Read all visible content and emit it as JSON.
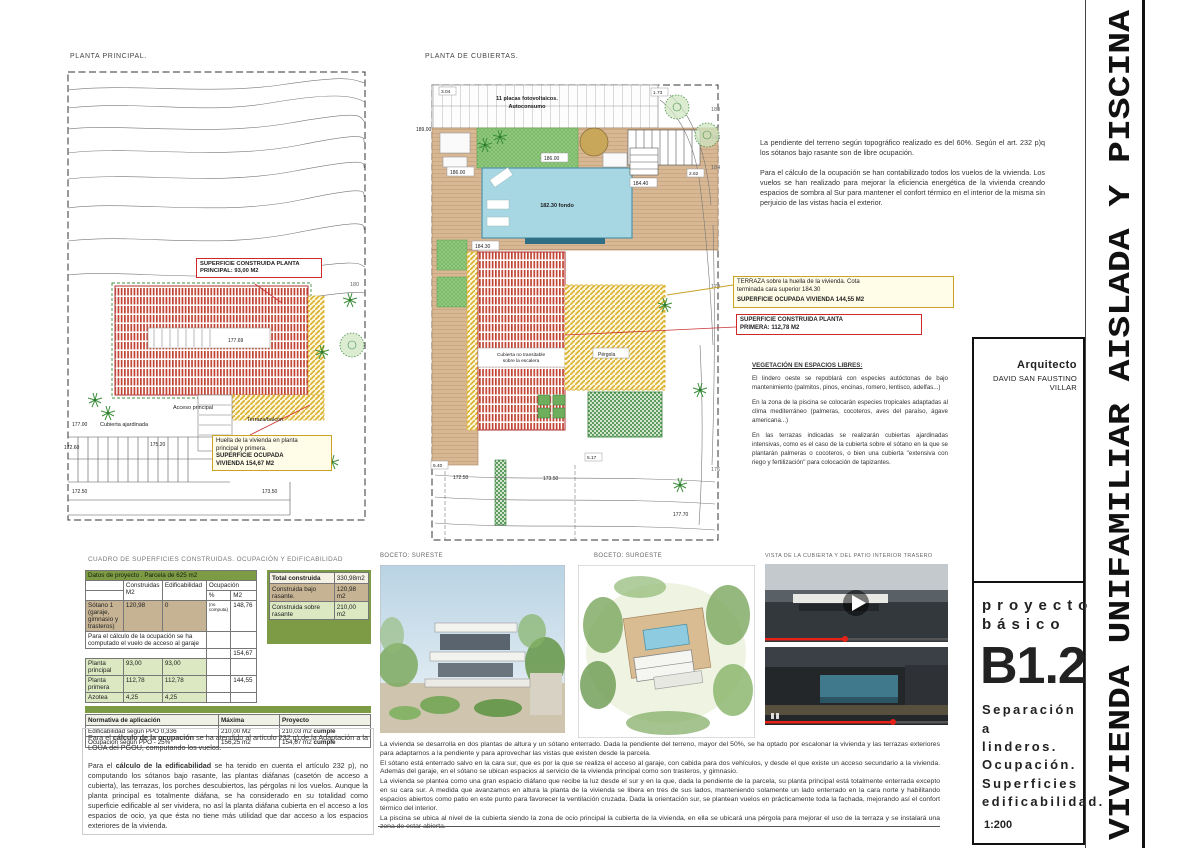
{
  "sheet": {
    "vertical_title": "VIVIENDA UNIFAMILIAR AISLADA Y PISCINA",
    "scale": "1:200",
    "architect_label": "Arquitecto",
    "architect_name": "DAVID SAN FAUSTINO VILLAR",
    "project_line1": "proyecto",
    "project_line2": "básico",
    "sheet_code": "B1.2",
    "subtitle_lines": {
      "l1": "Separación a",
      "l2": "linderos.",
      "l3": "Ocupación.",
      "l4": "Superficies",
      "l5": "edificabilidad."
    }
  },
  "colors": {
    "table_green": "#7d9a45",
    "table_green_light": "#dce8c2",
    "table_tan": "#c6b393",
    "pool_blue": "#a6d7e3",
    "deck_tan": "#d8b894",
    "grass_green": "#92c97f",
    "hatch_red": "#c14333",
    "hatch_yellow": "#d9af2b",
    "label_red_border": "#cc2a2a",
    "label_yellow_bg": "#fffce8",
    "progress_red": "#e62117"
  },
  "plan1": {
    "title": "PLANTA PRINCIPAL.",
    "box_construida": {
      "line1": "SUPERFICIE CONSTRUIDA PLANTA",
      "line2": "PRINCIPAL:  93,00 M2"
    },
    "box_huella": {
      "line1": "Huella de la vivienda en planta",
      "line2": "principal y primera.",
      "line3": "SUPERFICIE OCUPADA",
      "line4": "VIVIENDA 154,67 M2"
    },
    "labels": {
      "acceso": "Acceso principal",
      "terraza": "Terraza/balcón",
      "cubierta": "Cubierta ajardinada"
    },
    "levels": {
      "v17700": "177.00",
      "v17260": "172.60",
      "v17520": "175.20",
      "v17250": "172.50",
      "v17350": "173.50",
      "v17769": "177.69",
      "c180": "180"
    }
  },
  "plan2": {
    "title": "PLANTA DE CUBIERTAS.",
    "placas_line1": "11 placas fotovoltaicos.",
    "placas_line2": "Autoconsumo",
    "labels": {
      "pool": "182.30 fondo",
      "cubierta_escalera_1": "Cubierta no transitable",
      "cubierta_escalera_2": "sobre la escalera",
      "pergola": "Pérgola"
    },
    "box_terraza": {
      "line1": "TERRAZA sobre la huella de la vivienda.  Cota",
      "line2": "terminada cara superior 184.30",
      "line3": "SUPERFICIE OCUPADA VIVIENDA 144,55 M2"
    },
    "box_primera": {
      "line1": "SUPERFICIE CONSTRUIDA PLANTA",
      "line2": "PRIMERA:  112,78 M2"
    },
    "levels": {
      "v18900": "189.00",
      "grass": "186.00",
      "deck": "186.00",
      "v18440": "184.40",
      "v18430": "184.30",
      "v17250": "172.50",
      "v17350": "173.50",
      "v17770": "177.70",
      "c188": "188",
      "c186": "186",
      "c184": "184",
      "c179": "179",
      "c176": "176"
    },
    "dims": {
      "d304": "3.04",
      "d173": "1.73",
      "d262": "2.62",
      "d540": "5.40",
      "d517": "5.17"
    }
  },
  "notes_top_right": {
    "p1": "La pendiente del terreno según topográfico realizado es del 60%.  Según el art. 232 p)q los sótanos bajo rasante son de libre ocupación.",
    "p2": "Para el cálculo de la ocupación se han contabilizado todos los vuelos de la vivienda. Los vuelos se han realizado para mejorar la eficiencia energética de la vivienda creando espacios de sombra al Sur para mantener el confort térmico en el interior de la misma sin perjuicio de las vistas hacia el exterior."
  },
  "vegetacion": {
    "title": "VEGETACIÓN EN ESPACIOS LIBRES:",
    "p1": "El lindero oeste se repoblará con especies autóctonas de bajo mantenimiento (palmitos, pinos, encinas, romero, lentisco, adelfas...)",
    "p2": "En la zona de la piscina se colocarán especies tropicales adaptadas al clima mediterráneo (palmeras, cocoteros, aves del paraíso, ágave americana...)",
    "p3": "En las terrazas indicadas se realizarán cubiertas ajardinadas intensivas, como es el caso de la cubierta sobre el sótano en la que se plantarán palmeras o cocoteros, o bien una cubierta \"extensiva con riego y fertilización\" para colocación de tapizantes."
  },
  "cuadro": {
    "title": "CUADRO DE SUPERFICIES CONSTRUIDAS.  OCUPACIÓN Y EDIFICABILIDAD",
    "header": "Datos de proyecto .  Parcela de 625 m2",
    "cols": {
      "construidas": "Construidas",
      "m2": "M2",
      "edificabilidad": "Edificabilidad",
      "ocupacion": "Ocupación",
      "pct": "%",
      "m2b": "M2"
    },
    "rows": {
      "sotano": {
        "label": "Sótano 1 (garaje, gimnasio y trasteros)",
        "construidas": "120,98",
        "edificabilidad": "0",
        "ocup_pct": "(no computa)",
        "ocup_m2": "148,76"
      },
      "nota": "Para el cálculo de la ocupación se ha computado el vuelo de acceso al garaje",
      "ocup_total": "154,67",
      "principal": {
        "label": "Planta principal",
        "construidas": "93,00",
        "edificabilidad": "93,00"
      },
      "primera": {
        "label": "Planta primera",
        "construidas": "112,78",
        "edificabilidad": "112,78",
        "ocup_m2": "144,55"
      },
      "azotea": {
        "label": "Azotea",
        "construidas": "4,25",
        "edificabilidad": "4,25"
      }
    },
    "resumen": {
      "total_label": "Total construida",
      "total": "330,98m2",
      "bajo_label": "Construida bajo rasante.",
      "bajo": "120,98 m2",
      "sobre_label": "Construida sobre rasante",
      "sobre": "210,00 m2"
    },
    "normativa": {
      "h_label": "Normativa de aplicación",
      "h_max": "Máxima",
      "h_proy": "Proyecto",
      "r1": {
        "label": "Edificabilidad según PPO 0,336",
        "max": "210,00 M2",
        "proy": "210,03 m2",
        "cumple": "cumple"
      },
      "r2": {
        "label": "Ocupación según PPO - 25%",
        "max": "156,25 m2",
        "proy": "154,67 m2",
        "cumple": "cumple"
      }
    }
  },
  "notes_bottom_left": {
    "p1_pre": "Para el ",
    "p1_bold": "cálculo de la ocupación",
    "p1_post": " se ha atendido al artículo 232 q) de la Adaptación a la LOUA del PGOU, computando los vuelos.",
    "p2_pre": "Para el ",
    "p2_bold": "cálculo de la edificabilidad",
    "p2_post": " se ha tenido en cuenta el artículo 232 p), no computando los sótanos bajo rasante, las plantas diáfanas (casetón de acceso a cubierta), las terrazas, los porches descubiertos, las pérgolas ni los vuelos.  Aunque la planta principal es totalmente diáfana, se ha considerado en su totalidad como superficie edificable al ser vividera, no así la planta diáfana cubierta en el acceso a los espacios de ocio, ya que ésta no tiene más utilidad que dar acceso a los espacios exteriores de la vivienda."
  },
  "bocetos": {
    "b1_label": "BOCETO:  SURESTE",
    "b2_label": "BOCETO:  SUROESTE",
    "vista_label": "VISTA DE LA CUBIERTA Y DEL PATIO INTERIOR TRASERO"
  },
  "notes_bottom_center": {
    "p1": "La vivienda se desarrolla en dos plantas de altura y un sótano enterrado.  Dada la pendiente del terreno, mayor del 50%, se ha optado por escalonar la vivienda y las terrazas exteriores para adaptarnos a la pendiente y para aprovechar las vistas que existen desde la parcela.",
    "p2": "El sótano está enterrado salvo en la cara sur, que es por la que se realiza el acceso al garaje, con cabida para dos vehículos, y desde el que existe un acceso secundario a la vivienda.  Además del garaje, en el sótano se ubican espacios al servicio de la vivienda principal como son trasteros, y gimnasio.",
    "p3": "La vivienda se plantea como una gran espacio diáfano que recibe la luz desde el sur y en la que, dada la pendiente de la parcela, su planta principal está totalmente enterrada excepto en su cara sur.  A medida que avanzamos en altura la planta de la vivienda se libera en tres de sus lados, manteniendo solamente un lado enterrado en la cara norte y habilitando espacios abiertos como patio en este punto para favorecer la ventilación cruzada.  Dada la orientación sur, se plantean vuelos en prácticamente toda la fachada, mejorando así el confort térmico del interior.",
    "p4": "La piscina se ubica al nivel de la cubierta siendo la zona de ocio principal la cubierta de la vivienda, en ella se ubicará una pérgola para mejorar el uso de la terraza y se instalará una zona de estar abierta."
  }
}
